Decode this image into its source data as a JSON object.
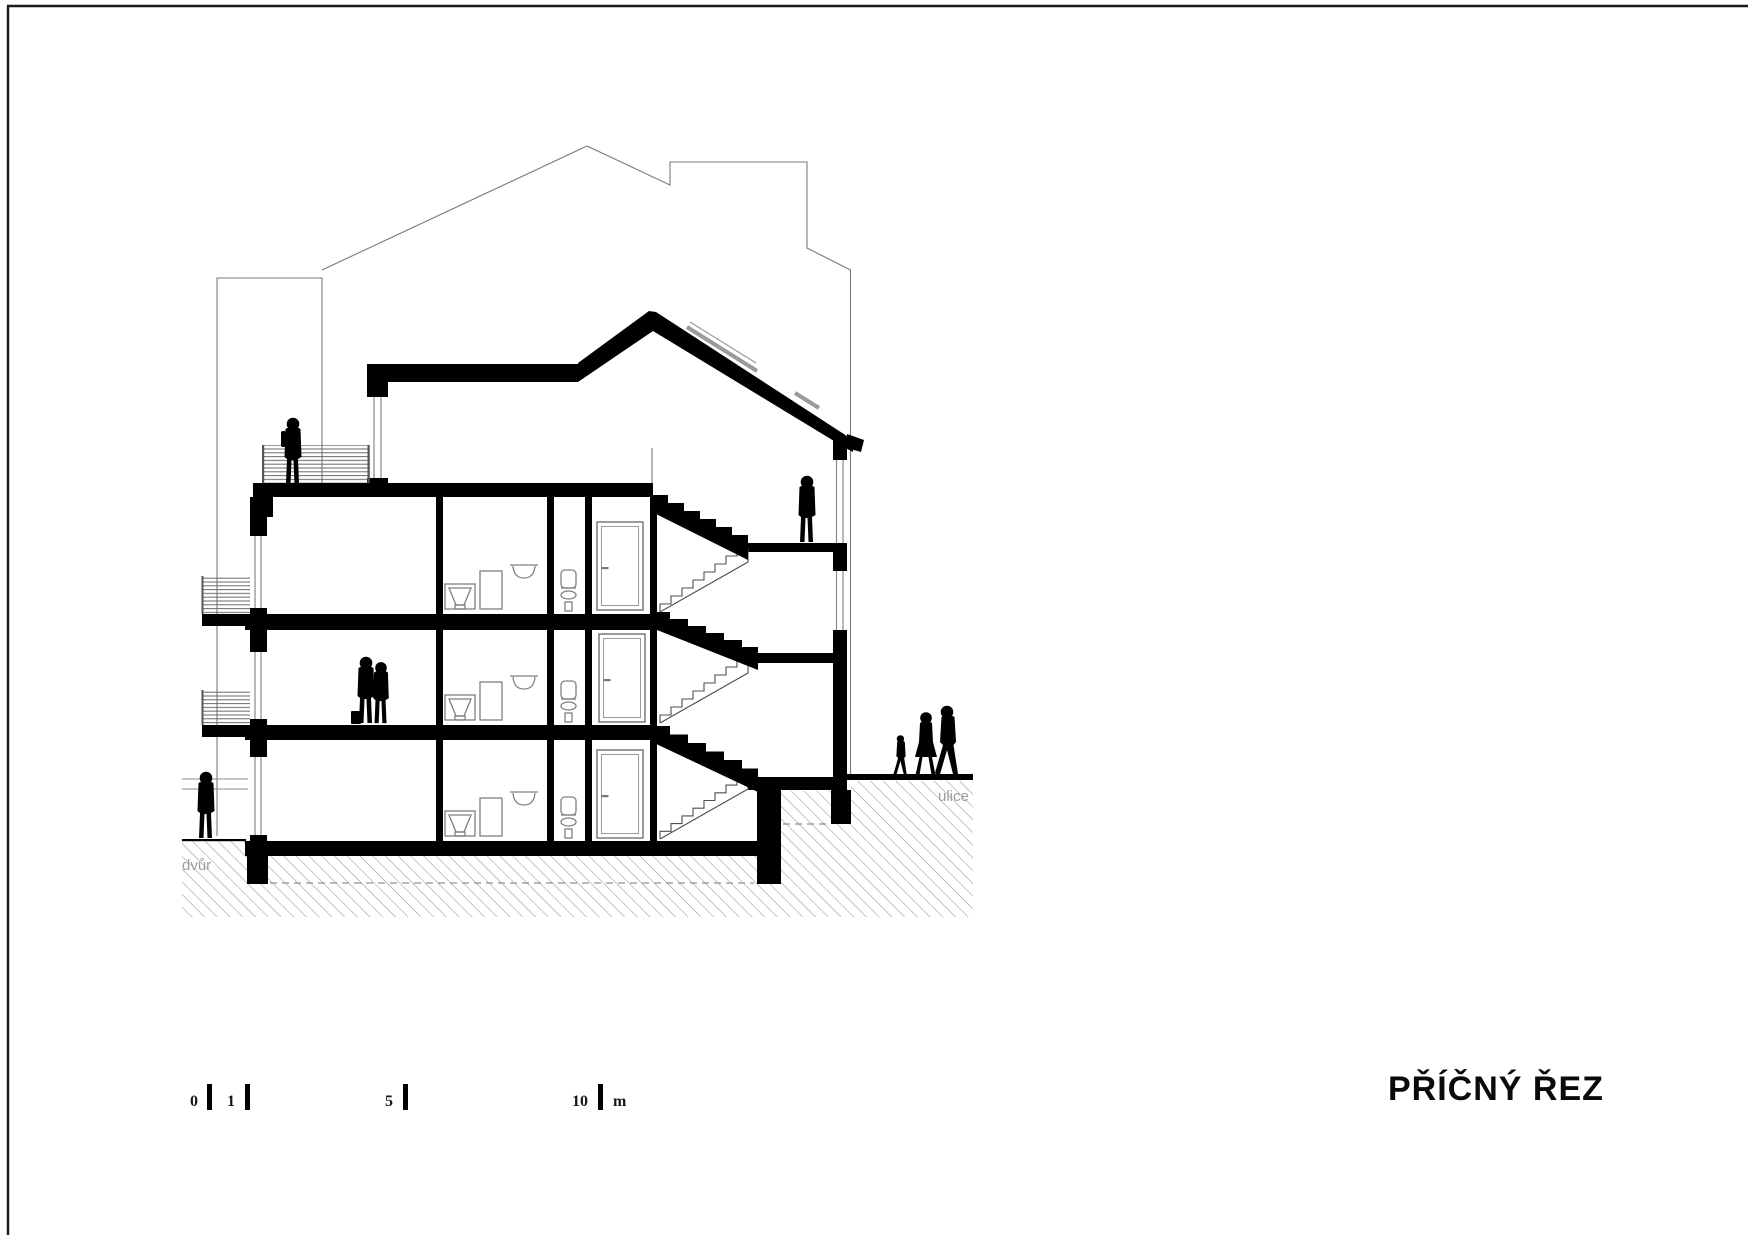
{
  "title_block": {
    "drawing_title": "PŘÍČNÝ ŘEZ"
  },
  "site_labels": {
    "courtyard": "dvůr",
    "street": "ulice"
  },
  "scale_bar": {
    "tick_labels": [
      "0",
      "1",
      "5",
      "10"
    ],
    "unit_label": "m"
  },
  "colors": {
    "ink": "#000000",
    "line_gray": "#7a7a7a",
    "window_gray": "#8a8a8a",
    "hatch_gray": "#8d8d8d",
    "label_gray": "#9e9e9e",
    "rail_gray": "#686868",
    "paper": "#ffffff",
    "frame": "#1a1a1a"
  }
}
